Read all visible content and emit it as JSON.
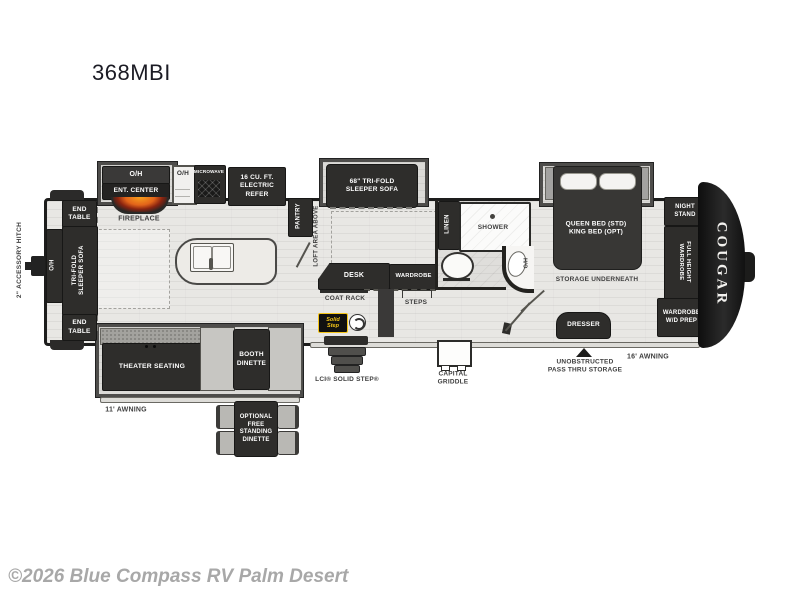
{
  "title": "368MBI",
  "watermark": "©2026 Blue Compass RV Palm Desert",
  "colors": {
    "wall": "#1d1d1c",
    "floor": "#e8e7e4",
    "furniture": "#2e2d2b",
    "flame": "#e8731f",
    "badge_yellow": "#f5c518"
  },
  "exterior": {
    "accessory_hitch": "2\" ACCESSORY HITCH",
    "brand_logo": "COUGAR",
    "awning_small": "11' AWNING",
    "awning_large": "16' AWNING",
    "entry_step": "LCI® SOLID STEP®",
    "solid_step_badge": "Solid\nStep",
    "griddle": "CAPITAL\nGRIDDLE",
    "pass_thru": "UNOBSTRUCTED\nPASS THRU STORAGE"
  },
  "rear_living": {
    "end_table_top": "END\nTABLE",
    "overhead": "O/H",
    "sofa": "TRI-FOLD\nSLEEPER SOFA",
    "end_table_bottom": "END\nTABLE"
  },
  "kitchen": {
    "overhead_cabinet": "O/H",
    "ent_center": "ENT. CENTER",
    "fireplace": "FIREPLACE",
    "overhead2": "O/H",
    "microwave": "MICROWAVE",
    "refrigerator": "16 CU. FT.\nELECTRIC\nREFER",
    "pantry": "PANTRY"
  },
  "living": {
    "loft": "LOFT AREA ABOVE",
    "sofa_68": "68\" TRI-FOLD\nSLEEPER SOFA",
    "desk": "DESK",
    "wardrobe": "WARDROBE",
    "coat_rack": "COAT RACK",
    "steps": "STEPS",
    "theater": "THEATER SEATING",
    "booth_dinette": "BOOTH\nDINETTE",
    "optional_dinette": "OPTIONAL\nFREE\nSTANDING\nDINETTE"
  },
  "bathroom": {
    "linen": "LINEN",
    "shower": "SHOWER",
    "overhead": "O/H"
  },
  "bedroom": {
    "bed": "QUEEN BED (STD)\nKING BED (OPT)",
    "storage": "STORAGE UNDERNEATH",
    "night_stand": "NIGHT\nSTAND",
    "full_wardrobe": "FULL HEIGHT\nWARDROBE",
    "wd_prep": "WARDROBE\nW/D PREP",
    "dresser": "DRESSER"
  }
}
